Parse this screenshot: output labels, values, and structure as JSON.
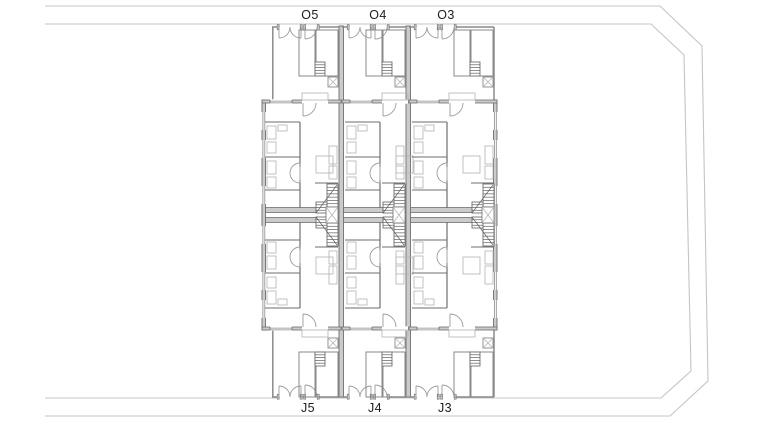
{
  "plan": {
    "labels_top": [
      "O5",
      "O4",
      "O3"
    ],
    "labels_bottom": [
      "J5",
      "J4",
      "J3"
    ],
    "colors": {
      "background": "#ffffff",
      "boundary": "#c4c4c4",
      "wall_fill": "#cbcbcb",
      "wall_edge": "#6e6e6e",
      "wall_line": "#8a8a8a",
      "thin_detail": "#b2b2b2",
      "door_arc": "#9c9c9c",
      "stair_hatch": "#5f5f5f",
      "label_text": "#1c1c1c"
    }
  }
}
